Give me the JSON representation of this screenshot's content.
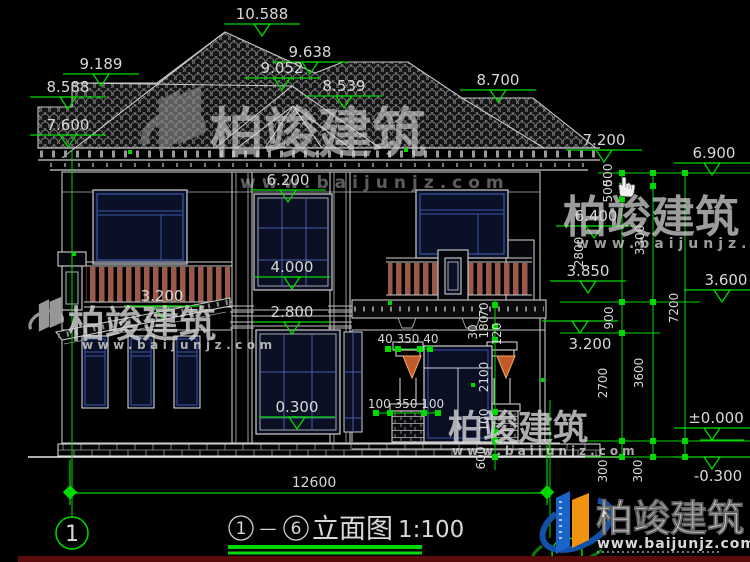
{
  "title_block": {
    "axis_start": "1",
    "separator": "—",
    "axis_end": "6",
    "name": "立面图",
    "scale": "1:100"
  },
  "axis_bubbles": {
    "left": "1"
  },
  "total_width": "12600",
  "elev": {
    "ridge": "10.588",
    "right_ridge": "9.638",
    "front_hip_top": "9.052",
    "front_hip_low": "8.539",
    "left_wing_top": "9.189",
    "left_wing_eave": "8.588",
    "left_eave": "7.600",
    "right_wing_eave": "8.700",
    "right_eave": "7.200",
    "right_outer_eave": "6.900",
    "second_ceiling": "6.200",
    "right_top": "6.400",
    "window_top": "4.000",
    "canopy_right": "3.850",
    "second_floor": "2.800",
    "canopy_left": "3.200",
    "porch_right": "3.200",
    "mid_right": "3.600",
    "first_sill": "0.300",
    "ground": "±0.000",
    "outdoor": "-0.300"
  },
  "chain": {
    "c500a": "500",
    "c500b": "500",
    "c2800": "2800",
    "c3300": "3300",
    "c900": "900",
    "c7200": "7200",
    "c2700": "2700",
    "c3600": "3600",
    "c300a": "300",
    "c300b": "300"
  },
  "small_dims": {
    "capital": "40 350 40",
    "pedestal": "100 350 100",
    "door_height": "2100",
    "plinth": "100",
    "step": "600",
    "s30": "30",
    "s180": "180",
    "s70": "70",
    "s120": "120"
  },
  "watermark": {
    "brand": "柏竣建筑",
    "url": "www.baijunjz.com"
  },
  "colors": {
    "annotation_green": "#00d800",
    "line_white": "#d0d0d0",
    "window_blue": "#3a55a8",
    "railing_brown": "#9a5a4a",
    "logo_blue": "#1b63c6",
    "logo_orange": "#f0930f",
    "bottom_bar_maroon": "#5a0b0b"
  }
}
